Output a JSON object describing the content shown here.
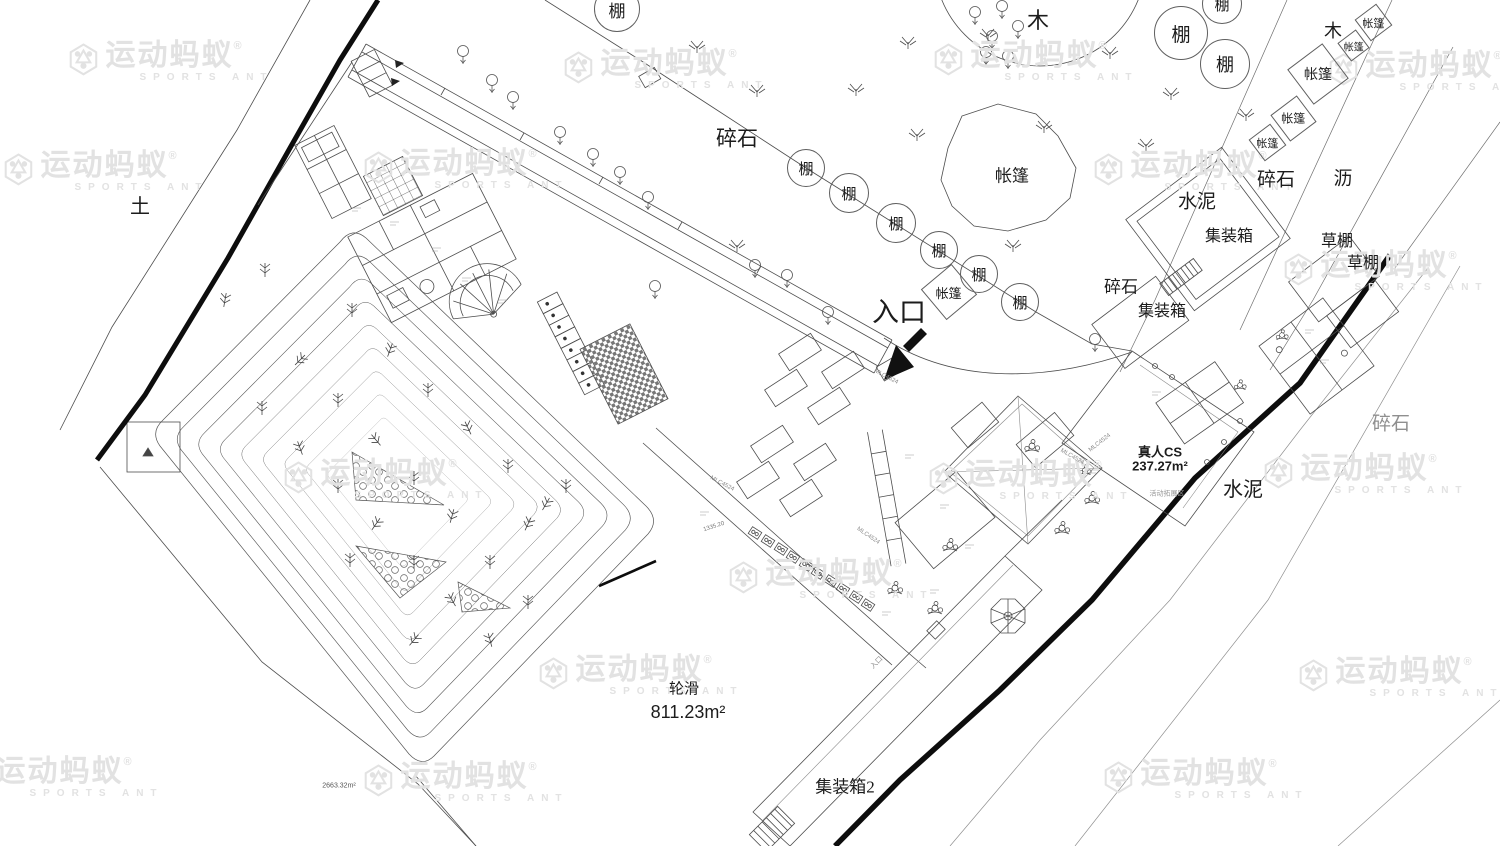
{
  "plan": {
    "watermark": {
      "brand": "运动蚂蚁",
      "reg": "®",
      "sub": "SPORTS ANT",
      "color": "#e2e2e2",
      "positions": [
        {
          "x": 170,
          "y": 62
        },
        {
          "x": 665,
          "y": 70
        },
        {
          "x": 1035,
          "y": 62
        },
        {
          "x": 1430,
          "y": 72
        },
        {
          "x": 105,
          "y": 172
        },
        {
          "x": 465,
          "y": 170
        },
        {
          "x": 1195,
          "y": 172
        },
        {
          "x": 1385,
          "y": 272
        },
        {
          "x": 385,
          "y": 480
        },
        {
          "x": 1030,
          "y": 481
        },
        {
          "x": 1365,
          "y": 475
        },
        {
          "x": 830,
          "y": 580
        },
        {
          "x": 640,
          "y": 676
        },
        {
          "x": 1400,
          "y": 678
        },
        {
          "x": 60,
          "y": 778
        },
        {
          "x": 465,
          "y": 783
        },
        {
          "x": 1205,
          "y": 780
        }
      ]
    },
    "labels": [
      {
        "text": "土",
        "x": 140,
        "y": 207,
        "size": 20
      },
      {
        "text": "碎石",
        "x": 737,
        "y": 139,
        "size": 21
      },
      {
        "text": "入口",
        "x": 899,
        "y": 313,
        "size": 27
      },
      {
        "text": "帐篷",
        "x": 1012,
        "y": 176,
        "size": 17
      },
      {
        "text": "木",
        "x": 1038,
        "y": 21,
        "size": 22
      },
      {
        "text": "木",
        "x": 1333,
        "y": 31,
        "size": 18
      },
      {
        "text": "碎石",
        "x": 1121,
        "y": 287,
        "size": 17
      },
      {
        "text": "集装箱",
        "x": 1162,
        "y": 312,
        "size": 16
      },
      {
        "text": "水泥",
        "x": 1197,
        "y": 202,
        "size": 19
      },
      {
        "text": "集装箱",
        "x": 1229,
        "y": 237,
        "size": 16
      },
      {
        "text": "碎石",
        "x": 1276,
        "y": 180,
        "size": 19
      },
      {
        "text": "沥",
        "x": 1343,
        "y": 179,
        "size": 19
      },
      {
        "text": "草棚",
        "x": 1337,
        "y": 242,
        "size": 16
      },
      {
        "text": "草棚",
        "x": 1363,
        "y": 264,
        "size": 16
      },
      {
        "text": "碎石",
        "x": 1391,
        "y": 424,
        "size": 19,
        "color": "#8f8f8f"
      },
      {
        "text": "水泥",
        "x": 1243,
        "y": 490,
        "size": 20
      },
      {
        "text": "真人CS",
        "x": 1160,
        "y": 452,
        "size": 13,
        "font": "sans",
        "bold": true
      },
      {
        "text": "237.27m²",
        "x": 1160,
        "y": 466,
        "size": 13,
        "font": "sans",
        "bold": true
      },
      {
        "text": "活动拓展区",
        "x": 1167,
        "y": 494,
        "size": 7,
        "color": "#999999"
      },
      {
        "text": "轮滑",
        "x": 684,
        "y": 690,
        "size": 15
      },
      {
        "text": "811.23m²",
        "x": 688,
        "y": 712,
        "size": 18,
        "font": "sans"
      },
      {
        "text": "集装箱2",
        "x": 845,
        "y": 787,
        "size": 17
      },
      {
        "text": "2663.32m²",
        "x": 339,
        "y": 786,
        "size": 7,
        "font": "sans",
        "color": "#555555"
      },
      {
        "text": "MLC4524",
        "x": 886,
        "y": 377,
        "size": 6,
        "rotate": 28,
        "color": "#8a8a8a",
        "font": "sans"
      },
      {
        "text": "MLC4524",
        "x": 722,
        "y": 484,
        "size": 6,
        "rotate": 28,
        "color": "#8a8a8a",
        "font": "sans"
      },
      {
        "text": "MLC4524",
        "x": 1072,
        "y": 457,
        "size": 6,
        "rotate": 30,
        "color": "#8a8a8a",
        "font": "sans"
      },
      {
        "text": "MLC4524",
        "x": 868,
        "y": 536,
        "size": 6,
        "rotate": 34,
        "color": "#8a8a8a",
        "font": "sans"
      },
      {
        "text": "MLC4524",
        "x": 1100,
        "y": 443,
        "size": 6,
        "rotate": -38,
        "color": "#8a8a8a",
        "font": "sans"
      },
      {
        "text": "1335.20",
        "x": 714,
        "y": 527,
        "size": 6,
        "rotate": -18,
        "color": "#777777",
        "font": "sans"
      },
      {
        "text": "入口",
        "x": 877,
        "y": 663,
        "size": 7,
        "rotate": -45,
        "color": "#8a8a8a"
      }
    ],
    "shed_circles": [
      {
        "text": "棚",
        "x": 617,
        "y": 9,
        "r": 22,
        "size": 17
      },
      {
        "text": "棚",
        "x": 1222,
        "y": 4,
        "r": 19,
        "size": 15
      },
      {
        "text": "棚",
        "x": 1181,
        "y": 33,
        "r": 26,
        "size": 19
      },
      {
        "text": "棚",
        "x": 1225,
        "y": 64,
        "r": 24,
        "size": 18
      },
      {
        "text": "棚",
        "x": 806,
        "y": 168,
        "r": 18,
        "size": 15
      },
      {
        "text": "棚",
        "x": 849,
        "y": 193,
        "r": 19,
        "size": 15
      },
      {
        "text": "棚",
        "x": 896,
        "y": 223,
        "r": 19,
        "size": 15
      },
      {
        "text": "棚",
        "x": 939,
        "y": 250,
        "r": 18,
        "size": 15
      },
      {
        "text": "棚",
        "x": 979,
        "y": 274,
        "r": 18,
        "size": 15
      },
      {
        "text": "棚",
        "x": 1020,
        "y": 302,
        "r": 18,
        "size": 15
      }
    ],
    "tent_diamonds": [
      {
        "text": "帐篷",
        "x": 948,
        "y": 291,
        "h": 27,
        "size": 13,
        "tilt": 5
      },
      {
        "text": "帐篷",
        "x": 1317,
        "y": 73,
        "h": 30,
        "size": 14,
        "tilt": 8
      },
      {
        "text": "帐篷",
        "x": 1292,
        "y": 117,
        "h": 22,
        "size": 12,
        "tilt": 8
      },
      {
        "text": "帐篷",
        "x": 1266,
        "y": 141,
        "h": 18,
        "size": 11,
        "tilt": 8
      },
      {
        "text": "帐篷",
        "x": 1372,
        "y": 21,
        "h": 18,
        "size": 11,
        "tilt": 8
      },
      {
        "text": "帐篷",
        "x": 1352,
        "y": 44,
        "h": 15,
        "size": 10,
        "tilt": 8
      }
    ]
  }
}
